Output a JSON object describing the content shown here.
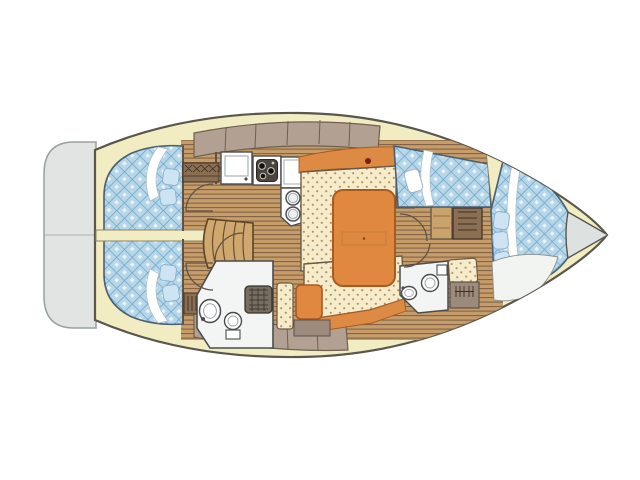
{
  "image": {
    "type": "sailboat-interior-floorplan",
    "orientation": "bow-right-stern-left"
  },
  "colors": {
    "bg": "#ffffff",
    "hull-stroke": "#59564c",
    "deck": "#f1ecc1",
    "deck-line": "#8a8468",
    "transom": "#e1e4e2",
    "transom-stroke": "#9aa0a0",
    "bow-gray": "#dde2e0",
    "berth-blue": "#b7d7e9",
    "berth-grid": "#6fa6c8",
    "berth-dot": "#eaf4fb",
    "berth-stroke": "#4a5f70",
    "pillow-blue": "#cfe4f2",
    "pillow-stroke": "#8ab4d2",
    "wood": "#c59c6a",
    "wood-line": "#7c5e40",
    "steps-wood": "#d0a76c",
    "steps-line": "#6b4e33",
    "wall": "#9c8a7c",
    "wall-stroke": "#5f5348",
    "cabinet": "#b2a193",
    "cabinet-seam": "#70604f",
    "settee": "#f6eccc",
    "settee-dot": "#b3945f",
    "settee-stroke": "#6b5a42",
    "orange-trim": "#dd8a45",
    "table-orange": "#e08840",
    "table-stroke": "#a85a20",
    "head-white": "#f3f5f5",
    "fixture-stroke": "#4c4c4c",
    "grate": "#776e62",
    "grate-line": "#36312a",
    "louver": "#8a6f52",
    "louver-line": "#3f3024",
    "dark-red": "#7a1f14",
    "stove": "#4a463e",
    "white": "#ffffff"
  },
  "features": [
    "transom-platform",
    "hull-deck",
    "aft-cabin-berth-starboard",
    "aft-cabin-berth-port",
    "engine-divider",
    "companionway-steps",
    "galley-sink-counter",
    "galley-stove",
    "galley-counter",
    "galley-double-sink",
    "salon-settee",
    "salon-table",
    "aft-head-toilet",
    "aft-head-sink",
    "shower-grate",
    "nav-seat",
    "chart-table",
    "forward-head-toilet",
    "forward-head-sink",
    "forward-berth-upper",
    "v-berth",
    "bow-anchor-locker",
    "hull-side-cabinets"
  ]
}
